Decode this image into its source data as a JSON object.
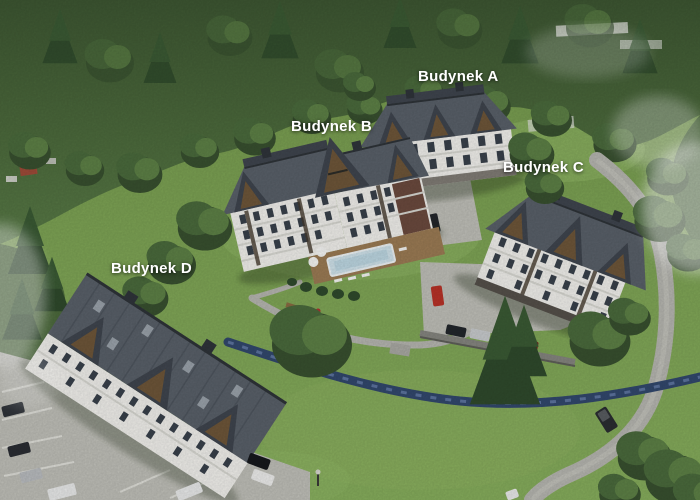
{
  "labels": {
    "building_a": "Budynek A",
    "building_b": "Budynek B",
    "building_c": "Budynek C",
    "building_d": "Budynek D"
  },
  "colors": {
    "labelText": "#ffffff",
    "forestDark": "#3c552f",
    "forestMid": "#4c6a3c",
    "forestLight": "#648b49",
    "grass": "#7ea455",
    "grassLight": "#93b968",
    "roofDark": "#3f454e",
    "roofMid": "#596069",
    "roofLight": "#7a828b",
    "facade": "#f1f0ec",
    "timber": "#453a2d",
    "wood": "#6e5639",
    "stone": "#85857f",
    "gravel": "#bfbfb8",
    "road": "#b6b6b0",
    "stream": "#32486d",
    "streamLight": "#6d86b3",
    "pool": "#cfe2ea",
    "deck": "#9b7b54",
    "carRed": "#b83227",
    "carBlack": "#22262b",
    "carWhite": "#e9eaea",
    "carOrange": "#cc6a1c",
    "carDarkRed": "#7e2020",
    "carSilver": "#b9bcbf"
  }
}
